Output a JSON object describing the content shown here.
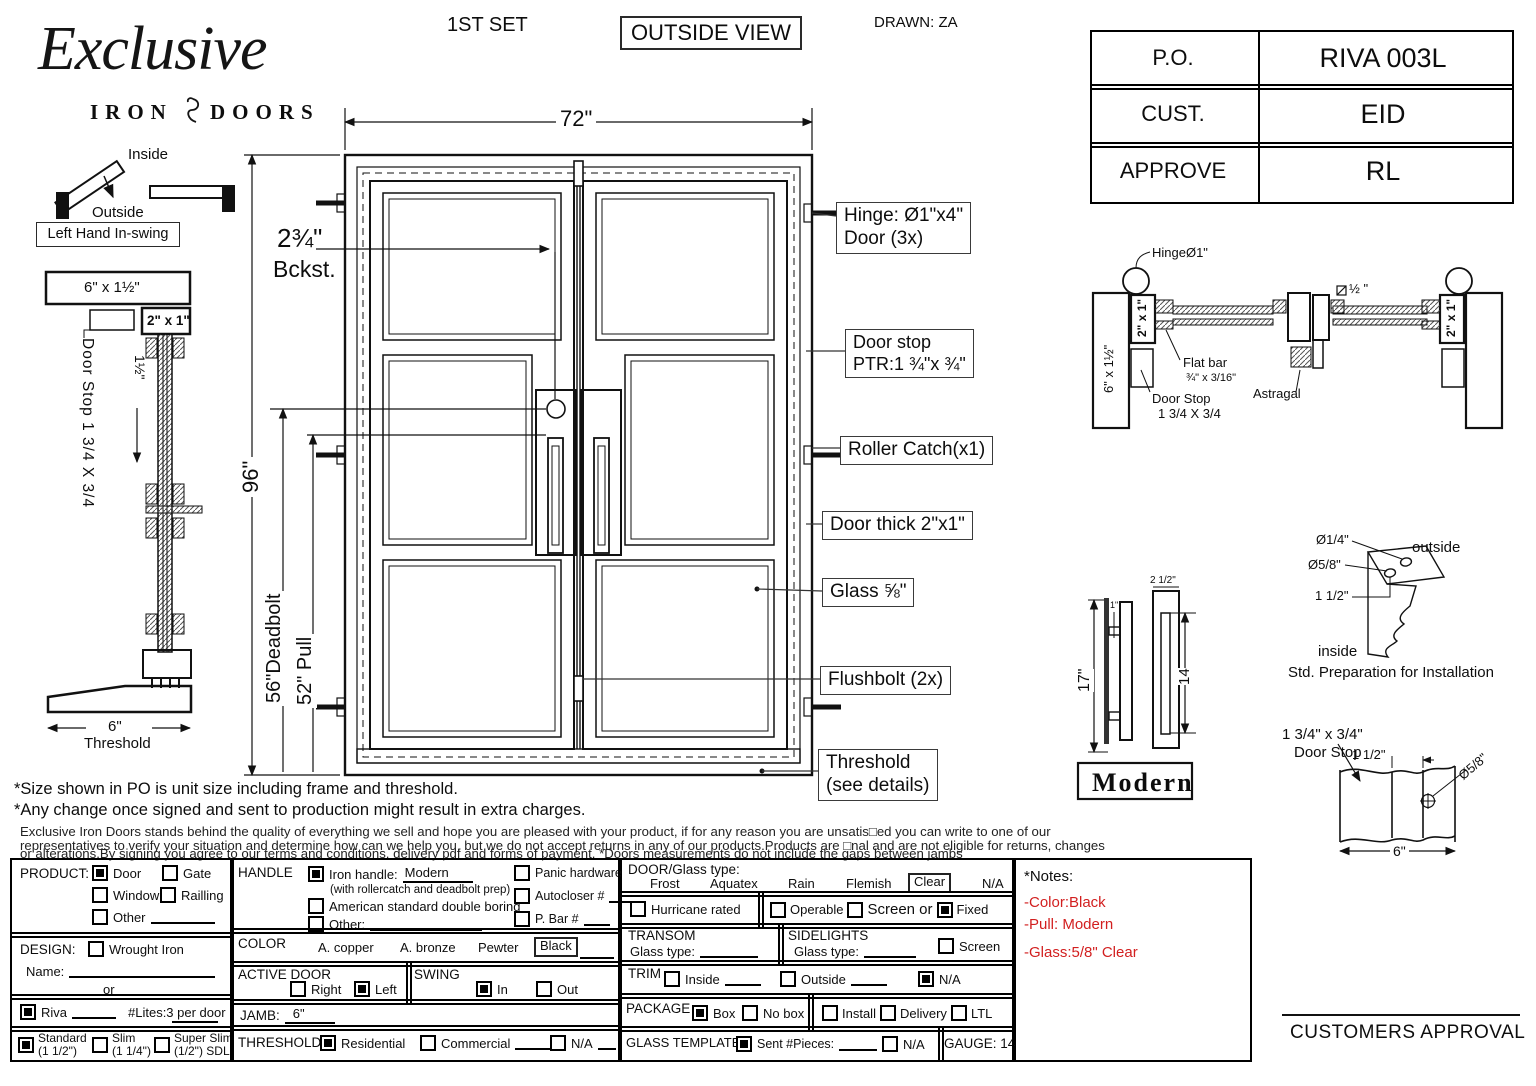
{
  "header": {
    "set": "1ST SET",
    "view": "OUTSIDE VIEW",
    "drawn": "DRAWN: ZA"
  },
  "logo": {
    "name": "Exclusive",
    "iron": "IRON",
    "doors": "DOORS"
  },
  "po_table": {
    "rows": [
      {
        "label": "P.O.",
        "value": "RIVA 003L"
      },
      {
        "label": "CUST.",
        "value": "EID"
      },
      {
        "label": "APPROVE",
        "value": "RL"
      }
    ]
  },
  "swing_icon": {
    "inside": "Inside",
    "outside": "Outside",
    "tag": "Left Hand In-swing"
  },
  "left_section": {
    "top_dim": "6\" x 1½\"",
    "frame_dim": "2\" x 1\"",
    "offset_dim": "1½\"",
    "door_stop": "Door Stop 1 3/4 X 3/4",
    "threshold_dim": "6\"",
    "threshold_label": "Threshold"
  },
  "door": {
    "width_dim": "72\"",
    "height_dim": "96\"",
    "backset_dim": "2¾\"",
    "backset_label": "Bckst.",
    "deadbolt_dim": "56\"Deadbolt",
    "pull_dim": "52\" Pull"
  },
  "callouts": {
    "hinge_line1": "Hinge: Ø1\"x4\"",
    "hinge_line2": "Door (3x)",
    "doorstop_line1": "Door stop",
    "doorstop_line2": "PTR:1 ¾\"x ¾\"",
    "roller": "Roller Catch(x1)",
    "thickness": "Door thick 2\"x1\"",
    "glass": "Glass ⅝\"",
    "flushbolt": "Flushbolt (2x)",
    "threshold_line1": "Threshold",
    "threshold_line2": "(see details)"
  },
  "head_section": {
    "hinge": "HingeØ1\"",
    "jamb_dim": "6\" x 1½\"",
    "frame_dim_left": "2\" x 1\"",
    "frame_dim_right": "2\" x 1\"",
    "gap_dim": "½ \"",
    "flat_bar_line1": "Flat bar",
    "flat_bar_line2": "¾\" x 3/16\"",
    "door_stop_line1": "Door Stop",
    "door_stop_line2": "1 3/4 X 3/4",
    "astragal": "Astragal"
  },
  "pull_detail": {
    "height_dim": "17\"",
    "standoff_dim": "1\"",
    "width_dim": "2 1/2\"",
    "slot_dim": "14",
    "name": "Modern"
  },
  "prep_detail": {
    "hole1": "Ø1/4\"",
    "hole2": "Ø5/8\"",
    "offset": "1 1/2\"",
    "outside": "outside",
    "inside": "inside",
    "caption": "Std. Preparation for Installation"
  },
  "stop_detail": {
    "size_line1": "1 3/4\" x 3/4\"",
    "size_line2": "Door Stop",
    "offset_dim": "1 1/2\"",
    "hole_dim": "Ø5/8\"",
    "width_dim": "6\""
  },
  "disclaimer": {
    "line1": "*Size shown in PO is unit size including frame and threshold.",
    "line2": "*Any change once signed and sent to production might result in extra charges.",
    "para1": "Exclusive Iron Doors stands behind the quality of everything we sell and hope you are pleased with your product, if for any reason you are unsatis□ed you can write to one of our",
    "para2": "representatives to verify your situation and determine how can we help you, but we do not accept returns in any of our products.Products are □nal and are not eligible for returns, changes",
    "para3": "or alterations.By signing you agree to our terms and conditions, delivery pdf and forms of payment. *Doors measurements do not include the gaps between jambs"
  },
  "form": {
    "product": {
      "label": "PRODUCT:",
      "door": "Door",
      "gate": "Gate",
      "window": "Window",
      "railing": "Railling",
      "other": "Other"
    },
    "design": {
      "label": "DESIGN:",
      "wrought": "Wrought Iron",
      "name_label": "Name:",
      "or_label": "or",
      "riva": "Riva",
      "lites": "#Lites:3 per door",
      "standard_line1": "Standard",
      "standard_line2": "(1 1/2\")",
      "slim_line1": "Slim",
      "slim_line2": "(1 1/4\")",
      "superslim_line1": "Super Slim",
      "superslim_line2": "(1/2\") SDL"
    },
    "handle": {
      "label": "HANDLE",
      "iron_label": "Iron handle:",
      "iron_value": "Modern",
      "iron_note": "(with rollercatch and deadbolt prep)",
      "american": "American standard double boring",
      "other_label": "Other:",
      "panic": "Panic hardware",
      "autocloser": "Autocloser #",
      "pbar": "P. Bar #"
    },
    "color": {
      "label": "COLOR",
      "copper": "A. copper",
      "bronze": "A. bronze",
      "pewter": "Pewter",
      "black": "Black"
    },
    "active_door": {
      "label": "ACTIVE DOOR",
      "right": "Right",
      "left": "Left"
    },
    "swing": {
      "label": "SWING",
      "in_label": "In",
      "out_label": "Out"
    },
    "jamb": {
      "label": "JAMB:",
      "value": "6\""
    },
    "threshold": {
      "label": "THRESHOLD",
      "residential": "Residential",
      "commercial": "Commercial",
      "na": "N/A"
    },
    "glass_type": {
      "label": "DOOR/Glass type:",
      "frost": "Frost",
      "aquatex": "Aquatex",
      "rain": "Rain",
      "flemish": "Flemish",
      "clear": "Clear",
      "na": "N/A"
    },
    "rated": {
      "hurricane": "Hurricane rated",
      "operable": "Operable",
      "screen_or": "Screen or",
      "fixed": "Fixed"
    },
    "transom": {
      "label": "TRANSOM",
      "glass_label": "Glass type:"
    },
    "sidelights": {
      "label": "SIDELIGHTS",
      "glass_label": "Glass type:",
      "screen": "Screen"
    },
    "trim": {
      "label": "TRIM",
      "inside": "Inside",
      "outside": "Outside",
      "na": "N/A"
    },
    "package": {
      "label": "PACKAGE",
      "box": "Box",
      "nobox": "No box",
      "install": "Install",
      "delivery": "Delivery",
      "ltl": "LTL"
    },
    "glass_template": {
      "label": "GLASS TEMPLATE",
      "sent": "Sent #Pieces:",
      "na": "N/A",
      "gauge": "GAUGE: 14"
    }
  },
  "notes": {
    "title": "*Notes:",
    "line1": "-Color:Black",
    "line2": "-Pull: Modern",
    "line3": "-Glass:5/8\" Clear",
    "accent": "#d21f1f"
  },
  "approval": {
    "label": "CUSTOMERS APPROVAL"
  }
}
